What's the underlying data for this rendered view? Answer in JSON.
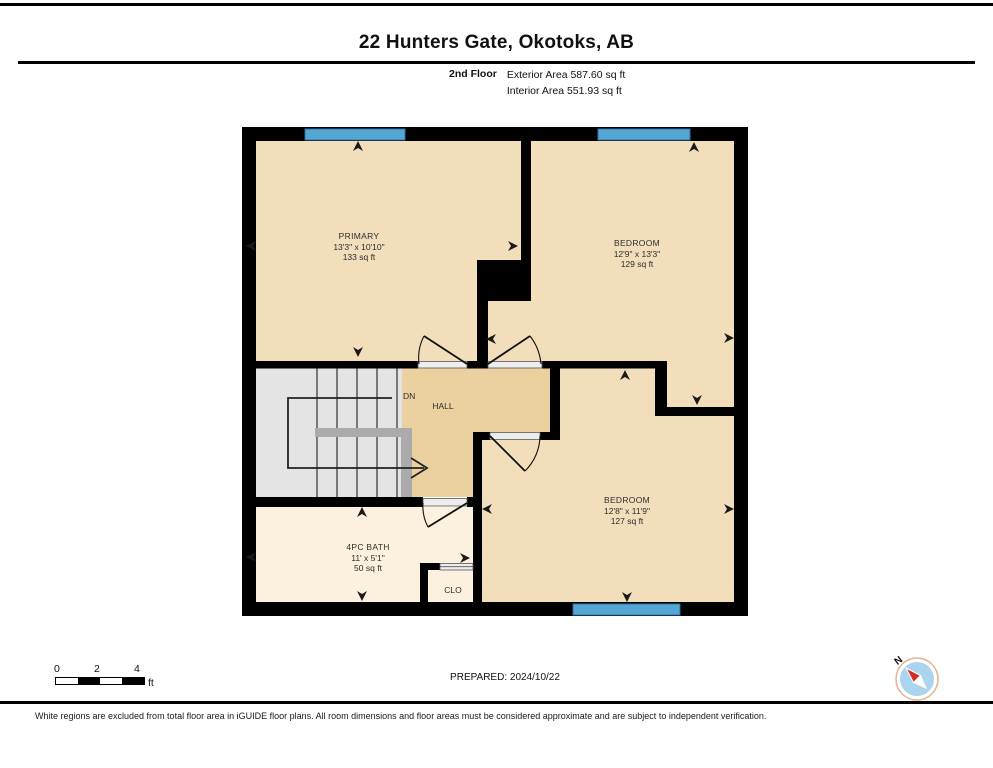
{
  "header": {
    "title": "22 Hunters Gate, Okotoks, AB",
    "floor_label": "2nd Floor",
    "exterior_area": "Exterior Area 587.60 sq ft",
    "interior_area": "Interior Area 551.93 sq ft"
  },
  "rooms": {
    "primary": {
      "name": "PRIMARY",
      "dimensions": "13'3\" x 10'10\"",
      "area": "133 sq ft"
    },
    "bedroom_top": {
      "name": "BEDROOM",
      "dimensions": "12'9\" x 13'3\"",
      "area": "129 sq ft"
    },
    "bedroom_bottom": {
      "name": "BEDROOM",
      "dimensions": "12'8\" x 11'9\"",
      "area": "127 sq ft"
    },
    "bath": {
      "name": "4PC BATH",
      "dimensions": "11' x 5'1\"",
      "area": "50 sq ft"
    },
    "closet": {
      "name": "CLO"
    },
    "hall": {
      "name": "HALL"
    },
    "stairs": {
      "down_label": "DN"
    }
  },
  "footer": {
    "scale": {
      "ticks": [
        "0",
        "2",
        "4"
      ],
      "unit": "ft"
    },
    "prepared": "PREPARED: 2024/10/22",
    "compass_north_label": "N",
    "disclaimer": "White regions are excluded from total floor area in iGUIDE floor plans. All room dimensions and floor areas must be considered approximate and are subject to independent verification."
  },
  "colors": {
    "wall": "#000000",
    "room_fill": "#F2DEBB",
    "hall_fill": "#EBD1A0",
    "bath_fill": "#FBF1DE",
    "stair_fill": "#E4E4E4",
    "banister": "#ABABAB",
    "window": "#54A7D5",
    "threshold": "#EDEDED",
    "compass_blue": "#ABD4EE",
    "compass_red": "#D42B20"
  }
}
